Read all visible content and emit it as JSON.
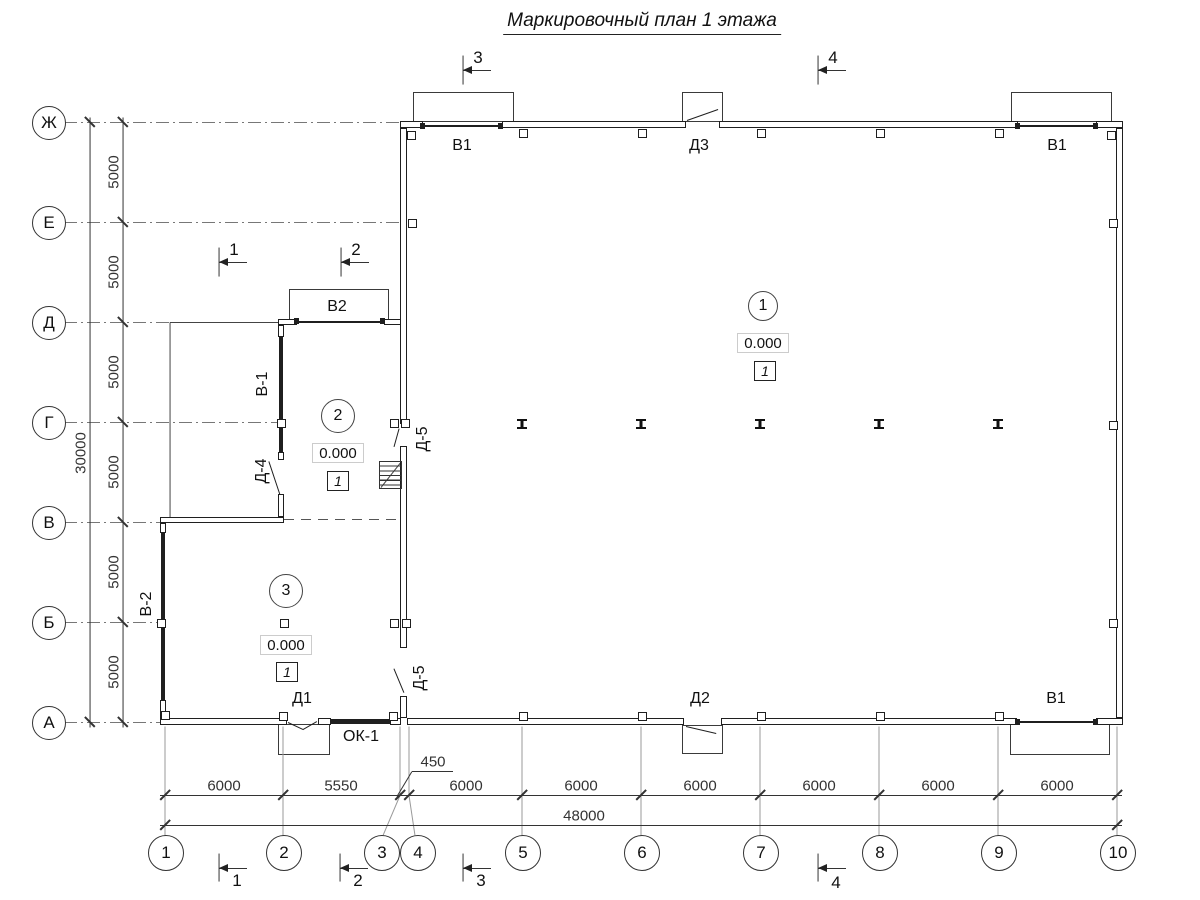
{
  "title": "Маркировочный план 1 этажа",
  "colors": {
    "line": "#222222",
    "gray_ext": "#9a9a9a",
    "background": "#ffffff"
  },
  "axes": {
    "left": [
      {
        "label": "Ж",
        "cy": 122
      },
      {
        "label": "Е",
        "cy": 222
      },
      {
        "label": "Д",
        "cy": 322
      },
      {
        "label": "Г",
        "cy": 422
      },
      {
        "label": "В",
        "cy": 522
      },
      {
        "label": "Б",
        "cy": 622
      },
      {
        "label": "А",
        "cy": 722
      }
    ],
    "bottom": [
      {
        "label": "1",
        "cx": 165
      },
      {
        "label": "2",
        "cx": 283
      },
      {
        "label": "3",
        "cx": 381
      },
      {
        "label": "4",
        "cx": 417
      },
      {
        "label": "5",
        "cx": 522
      },
      {
        "label": "6",
        "cx": 641
      },
      {
        "label": "7",
        "cx": 760
      },
      {
        "label": "8",
        "cx": 879
      },
      {
        "label": "9",
        "cx": 998
      },
      {
        "label": "10",
        "cx": 1117
      }
    ]
  },
  "dimensions": {
    "texts": [
      {
        "t": "6000",
        "x": 224,
        "y": 786,
        "rot": 0
      },
      {
        "t": "5550",
        "x": 341,
        "y": 786,
        "rot": 0
      },
      {
        "t": "450",
        "x": 433,
        "y": 762,
        "rot": 0
      },
      {
        "t": "6000",
        "x": 466,
        "y": 786,
        "rot": 0
      },
      {
        "t": "6000",
        "x": 581,
        "y": 786,
        "rot": 0
      },
      {
        "t": "6000",
        "x": 700,
        "y": 786,
        "rot": 0
      },
      {
        "t": "6000",
        "x": 819,
        "y": 786,
        "rot": 0
      },
      {
        "t": "6000",
        "x": 938,
        "y": 786,
        "rot": 0
      },
      {
        "t": "6000",
        "x": 1057,
        "y": 786,
        "rot": 0
      },
      {
        "t": "48000",
        "x": 584,
        "y": 816,
        "rot": 0
      },
      {
        "t": "5000",
        "x": 114,
        "y": 172,
        "rot": -90
      },
      {
        "t": "5000",
        "x": 114,
        "y": 272,
        "rot": -90
      },
      {
        "t": "5000",
        "x": 114,
        "y": 372,
        "rot": -90
      },
      {
        "t": "5000",
        "x": 114,
        "y": 472,
        "rot": -90
      },
      {
        "t": "5000",
        "x": 114,
        "y": 572,
        "rot": -90
      },
      {
        "t": "5000",
        "x": 114,
        "y": 672,
        "rot": -90
      },
      {
        "t": "30000",
        "x": 81,
        "y": 453,
        "rot": -90
      }
    ]
  },
  "section_markers": [
    {
      "t": "3",
      "bx": 463,
      "by1": 55,
      "by2": 84,
      "ly": 70,
      "tx": 478,
      "ty": 58
    },
    {
      "t": "4",
      "bx": 818,
      "by1": 55,
      "by2": 84,
      "ly": 70,
      "tx": 833,
      "ty": 58
    },
    {
      "t": "1",
      "bx": 219,
      "by1": 247,
      "by2": 276,
      "ly": 262,
      "tx": 234,
      "ty": 250
    },
    {
      "t": "2",
      "bx": 341,
      "by1": 247,
      "by2": 276,
      "ly": 262,
      "tx": 356,
      "ty": 250
    },
    {
      "t": "1",
      "bx": 219,
      "by1": 853,
      "by2": 881,
      "ly": 868,
      "tx": 237,
      "ty": 881
    },
    {
      "t": "2",
      "bx": 340,
      "by1": 853,
      "by2": 881,
      "ly": 868,
      "tx": 358,
      "ty": 881
    },
    {
      "t": "3",
      "bx": 463,
      "by1": 853,
      "by2": 881,
      "ly": 868,
      "tx": 481,
      "ty": 881
    },
    {
      "t": "4",
      "bx": 818,
      "by1": 853,
      "by2": 881,
      "ly": 868,
      "tx": 836,
      "ty": 883
    }
  ],
  "opening_labels": [
    {
      "t": "В1",
      "x": 462,
      "y": 146,
      "rot": 0
    },
    {
      "t": "Д3",
      "x": 699,
      "y": 146,
      "rot": 0
    },
    {
      "t": "В1",
      "x": 1057,
      "y": 146,
      "rot": 0
    },
    {
      "t": "В2",
      "x": 337,
      "y": 307,
      "rot": 0
    },
    {
      "t": "В-1",
      "x": 263,
      "y": 384,
      "rot": -90
    },
    {
      "t": "Д-4",
      "x": 262,
      "y": 471,
      "rot": -90
    },
    {
      "t": "Д-5",
      "x": 423,
      "y": 439,
      "rot": -90
    },
    {
      "t": "Д-5",
      "x": 420,
      "y": 678,
      "rot": -90
    },
    {
      "t": "В-2",
      "x": 147,
      "y": 604,
      "rot": -90
    },
    {
      "t": "Д1",
      "x": 302,
      "y": 699,
      "rot": 0
    },
    {
      "t": "ОК-1",
      "x": 361,
      "y": 737,
      "rot": 0
    },
    {
      "t": "Д2",
      "x": 700,
      "y": 699,
      "rot": 0
    },
    {
      "t": "В1",
      "x": 1056,
      "y": 699,
      "rot": 0
    }
  ],
  "rooms": [
    {
      "num": "1",
      "cx": 762,
      "cy": 305,
      "r": 14,
      "elev": "0.000",
      "ex": 762,
      "ey": 342,
      "floor": "1",
      "fx": 764,
      "fy": 370
    },
    {
      "num": "2",
      "cx": 337,
      "cy": 415,
      "r": 16,
      "elev": "0.000",
      "ex": 337,
      "ey": 452,
      "floor": "1",
      "fx": 337,
      "fy": 480
    },
    {
      "num": "3",
      "cx": 285,
      "cy": 590,
      "r": 16,
      "elev": "0.000",
      "ex": 285,
      "ey": 644,
      "floor": "1",
      "fx": 286,
      "fy": 671
    }
  ],
  "plan": {
    "walls": [
      [
        400,
        121,
        23,
        7
      ],
      [
        502,
        121,
        184,
        7
      ],
      [
        719,
        121,
        299,
        7
      ],
      [
        1096,
        121,
        27,
        7
      ],
      [
        407,
        718,
        277,
        7
      ],
      [
        721,
        718,
        296,
        7
      ],
      [
        1096,
        718,
        27,
        7
      ],
      [
        400,
        128,
        7,
        296
      ],
      [
        400,
        446,
        7,
        202
      ],
      [
        400,
        696,
        7,
        22
      ],
      [
        1116,
        128,
        7,
        590
      ],
      [
        278,
        319,
        19,
        6
      ],
      [
        384,
        319,
        17,
        6
      ],
      [
        278,
        325,
        6,
        12
      ],
      [
        278,
        452,
        6,
        8
      ],
      [
        278,
        494,
        6,
        23
      ],
      [
        160,
        517,
        124,
        6
      ],
      [
        160,
        523,
        6,
        10
      ],
      [
        160,
        700,
        6,
        18
      ],
      [
        160,
        718,
        127,
        7
      ],
      [
        318,
        718,
        13,
        7
      ],
      [
        390,
        718,
        11,
        7
      ]
    ],
    "bands": [
      [
        279,
        337,
        4,
        115
      ],
      [
        161,
        533,
        4,
        167
      ],
      [
        330,
        719,
        60,
        5
      ]
    ],
    "canopies": [
      [
        413,
        92,
        101,
        30
      ],
      [
        682,
        92,
        41,
        30
      ],
      [
        1011,
        92,
        101,
        30
      ],
      [
        289,
        289,
        100,
        33
      ],
      [
        278,
        724,
        52,
        31
      ],
      [
        682,
        725,
        41,
        29
      ],
      [
        1010,
        722,
        100,
        33
      ]
    ],
    "thin_lines": [
      [
        170,
        322,
        170,
        517
      ],
      [
        170,
        322,
        278,
        322
      ],
      [
        381,
        487,
        400,
        463
      ]
    ],
    "door_leaves": [
      [
        687,
        120,
        718,
        109
      ],
      [
        686,
        726,
        716,
        733
      ],
      [
        288,
        722,
        303,
        729
      ],
      [
        303,
        729,
        317,
        721
      ],
      [
        280,
        494,
        269,
        461
      ],
      [
        399,
        428,
        394,
        446
      ],
      [
        404,
        692,
        394,
        668
      ]
    ],
    "gate_lines": [
      [
        423,
        125,
        502,
        125
      ],
      [
        1018,
        125,
        1096,
        125
      ],
      [
        297,
        321,
        384,
        321
      ],
      [
        1018,
        721,
        1096,
        721
      ]
    ],
    "gate_ends": [
      [
        420,
        123
      ],
      [
        498,
        123
      ],
      [
        1015,
        123
      ],
      [
        1093,
        123
      ],
      [
        294,
        318
      ],
      [
        380,
        318
      ],
      [
        1015,
        719
      ],
      [
        1093,
        719
      ]
    ],
    "dashdot": [
      [
        64,
        122,
        400,
        122
      ],
      [
        64,
        222,
        400,
        222
      ],
      [
        64,
        322,
        170,
        322
      ],
      [
        64,
        422,
        278,
        422
      ],
      [
        64,
        522,
        160,
        522
      ],
      [
        64,
        622,
        160,
        622
      ],
      [
        64,
        722,
        160,
        722
      ]
    ],
    "dashed": [
      [
        284,
        519,
        400,
        519
      ]
    ],
    "ext_gray": [
      [
        165,
        726,
        165,
        835
      ],
      [
        283,
        726,
        283,
        835
      ],
      [
        522,
        726,
        522,
        835
      ],
      [
        641,
        726,
        641,
        835
      ],
      [
        760,
        726,
        760,
        835
      ],
      [
        879,
        726,
        879,
        835
      ],
      [
        998,
        726,
        998,
        835
      ],
      [
        1117,
        726,
        1117,
        835
      ],
      [
        400,
        726,
        400,
        795
      ],
      [
        409,
        726,
        409,
        795
      ],
      [
        400,
        795,
        383,
        835
      ],
      [
        409,
        795,
        415,
        835
      ]
    ],
    "dim_lines": [
      [
        160,
        795,
        1122,
        795
      ],
      [
        160,
        825,
        1122,
        825
      ],
      [
        90,
        117,
        90,
        727
      ],
      [
        123,
        117,
        123,
        727
      ]
    ],
    "leader_450": [
      [
        397,
        796,
        412,
        771
      ],
      [
        412,
        771,
        453,
        771
      ]
    ],
    "ticks_h": [
      [
        165,
        795
      ],
      [
        283,
        795
      ],
      [
        400,
        795
      ],
      [
        409,
        795
      ],
      [
        522,
        795
      ],
      [
        641,
        795
      ],
      [
        760,
        795
      ],
      [
        879,
        795
      ],
      [
        998,
        795
      ],
      [
        1117,
        795
      ],
      [
        165,
        825
      ],
      [
        1117,
        825
      ]
    ],
    "ticks_v": [
      [
        90,
        122
      ],
      [
        90,
        722
      ],
      [
        123,
        122
      ],
      [
        123,
        222
      ],
      [
        123,
        322
      ],
      [
        123,
        422
      ],
      [
        123,
        522
      ],
      [
        123,
        622
      ],
      [
        123,
        722
      ]
    ],
    "pilasters": [
      [
        519,
        129
      ],
      [
        638,
        129
      ],
      [
        757,
        129
      ],
      [
        876,
        129
      ],
      [
        995,
        129
      ],
      [
        407,
        131
      ],
      [
        1107,
        131
      ],
      [
        408,
        219
      ],
      [
        1109,
        219
      ],
      [
        390,
        419
      ],
      [
        401,
        419
      ],
      [
        277,
        419
      ],
      [
        1109,
        421
      ],
      [
        390,
        619
      ],
      [
        402,
        619
      ],
      [
        1109,
        619
      ],
      [
        519,
        712
      ],
      [
        638,
        712
      ],
      [
        757,
        712
      ],
      [
        876,
        712
      ],
      [
        995,
        712
      ],
      [
        279,
        712
      ],
      [
        389,
        712
      ],
      [
        161,
        711
      ],
      [
        157,
        619
      ],
      [
        280,
        619
      ]
    ],
    "ibeams": [
      [
        522,
        424
      ],
      [
        641,
        424
      ],
      [
        760,
        424
      ],
      [
        879,
        424
      ],
      [
        998,
        424
      ]
    ],
    "stairs": {
      "x": 379,
      "y": 461,
      "w": 23,
      "h": 28
    }
  }
}
